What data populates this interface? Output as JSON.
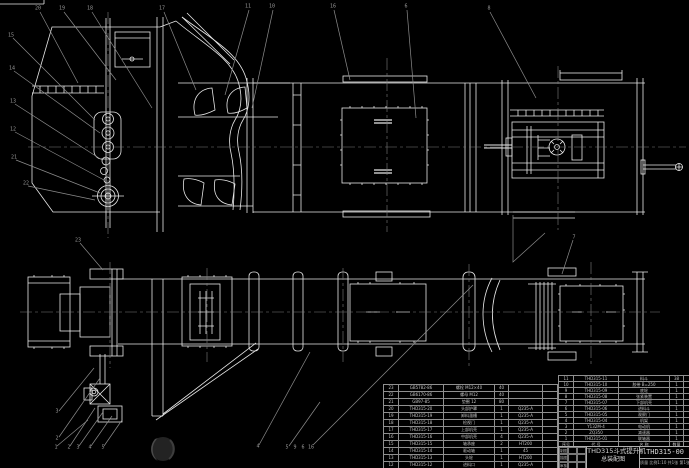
{
  "drawing": {
    "title_line1": "THD315斗式提升机",
    "title_line2": "总装配图",
    "drawing_number": "THD315-00",
    "info_row": "质量  比例1:10  共1张 第1张",
    "signature_labels": [
      "制图",
      "",
      "",
      "描图",
      "",
      "",
      "审核",
      "",
      ""
    ]
  },
  "colors": {
    "background": "#000000",
    "line_white": "#e8e8e8",
    "leader_gray": "#8c8c8c",
    "text_gray": "#c2c2c2"
  },
  "watermark": {
    "name": "crescent-logo"
  },
  "bom_right": {
    "rows": [
      [
        "11",
        "THD315-11",
        "料斗",
        "38",
        "Q235-A",
        "",
        "",
        ""
      ],
      [
        "10",
        "THD315-10",
        "胶带 B=250",
        "1",
        "橡胶",
        "",
        "",
        ""
      ],
      [
        "9",
        "THD315-09",
        "底轮",
        "1",
        "HT200",
        "",
        "",
        ""
      ],
      [
        "8",
        "THD315-08",
        "张紧装置",
        "1",
        "",
        "",
        "",
        ""
      ],
      [
        "7",
        "THD315-07",
        "下部机壳",
        "1",
        "Q235-A",
        "",
        "",
        ""
      ],
      [
        "6",
        "THD315-06",
        "进料斗",
        "1",
        "Q235-A",
        "",
        "",
        ""
      ],
      [
        "5",
        "THD315-05",
        "观察门",
        "1",
        "Q235-A",
        "",
        "",
        ""
      ],
      [
        "4",
        "THD315-04",
        "机架",
        "1",
        "Q235-A",
        "",
        "",
        ""
      ],
      [
        "3",
        "Y132M-4",
        "电动机",
        "1",
        "",
        "",
        "",
        ""
      ],
      [
        "2",
        "ZQ350",
        "减速器",
        "1",
        "",
        "",
        "",
        ""
      ],
      [
        "1",
        "THD315-01",
        "联轴器",
        "1",
        "HT200",
        "",
        "",
        ""
      ],
      [
        "序号",
        "代 号",
        "名 称",
        "数量",
        "材 料",
        "单件",
        "总计",
        "备注"
      ]
    ]
  },
  "bom_left": {
    "rows": [
      [
        "23",
        "GB5782-86",
        "螺栓 M12×40",
        "40",
        "",
        "",
        "",
        ""
      ],
      [
        "22",
        "GB6170-86",
        "螺母 M12",
        "40",
        "",
        "",
        "",
        ""
      ],
      [
        "21",
        "GB97-85",
        "垫圈 12",
        "80",
        "",
        "",
        "",
        ""
      ],
      [
        "20",
        "THD315-20",
        "头部护罩",
        "1",
        "Q235-A",
        "",
        "",
        ""
      ],
      [
        "19",
        "THD315-19",
        "卸料溜槽",
        "1",
        "Q235-A",
        "",
        "",
        ""
      ],
      [
        "18",
        "THD315-18",
        "检视门",
        "1",
        "Q235-A",
        "",
        "",
        ""
      ],
      [
        "17",
        "THD315-17",
        "上部机壳",
        "1",
        "Q235-A",
        "",
        "",
        ""
      ],
      [
        "16",
        "THD315-16",
        "中部机壳",
        "4",
        "Q235-A",
        "",
        "",
        ""
      ],
      [
        "15",
        "THD315-15",
        "轴承座",
        "2",
        "HT200",
        "",
        "",
        ""
      ],
      [
        "14",
        "THD315-14",
        "驱动轴",
        "1",
        "45",
        "",
        "",
        ""
      ],
      [
        "13",
        "THD315-13",
        "头轮",
        "1",
        "HT200",
        "",
        "",
        ""
      ],
      [
        "12",
        "THD315-12",
        "进料口",
        "1",
        "Q235-A",
        "",
        "",
        ""
      ]
    ]
  },
  "balloons": [
    {
      "x": 38,
      "y": 9,
      "label": "20"
    },
    {
      "x": 62,
      "y": 9,
      "label": "19"
    },
    {
      "x": 90,
      "y": 9,
      "label": "18"
    },
    {
      "x": 162,
      "y": 9,
      "label": "17"
    },
    {
      "x": 248,
      "y": 7,
      "label": "11"
    },
    {
      "x": 272,
      "y": 7,
      "label": "10"
    },
    {
      "x": 333,
      "y": 7,
      "label": "16"
    },
    {
      "x": 406,
      "y": 7,
      "label": "6"
    },
    {
      "x": 489,
      "y": 9,
      "label": "8"
    },
    {
      "x": 11,
      "y": 36,
      "label": "15"
    },
    {
      "x": 12,
      "y": 69,
      "label": "14"
    },
    {
      "x": 13,
      "y": 102,
      "label": "13"
    },
    {
      "x": 13,
      "y": 130,
      "label": "12"
    },
    {
      "x": 14,
      "y": 158,
      "label": "21"
    },
    {
      "x": 26,
      "y": 184,
      "label": "22"
    },
    {
      "x": 78,
      "y": 241,
      "label": "23"
    },
    {
      "x": 574,
      "y": 238,
      "label": "7"
    },
    {
      "x": 57,
      "y": 412,
      "label": "3"
    },
    {
      "x": 57,
      "y": 439,
      "label": "2"
    },
    {
      "x": 56,
      "y": 448,
      "label": "1"
    },
    {
      "x": 69,
      "y": 448,
      "label": "2"
    },
    {
      "x": 78,
      "y": 448,
      "label": "3"
    },
    {
      "x": 90,
      "y": 448,
      "label": "4"
    },
    {
      "x": 103,
      "y": 448,
      "label": "5"
    },
    {
      "x": 258,
      "y": 447,
      "label": "4"
    },
    {
      "x": 287,
      "y": 448,
      "label": "5"
    },
    {
      "x": 295,
      "y": 448,
      "label": "9"
    },
    {
      "x": 303,
      "y": 448,
      "label": "6"
    },
    {
      "x": 311,
      "y": 448,
      "label": "16"
    }
  ]
}
